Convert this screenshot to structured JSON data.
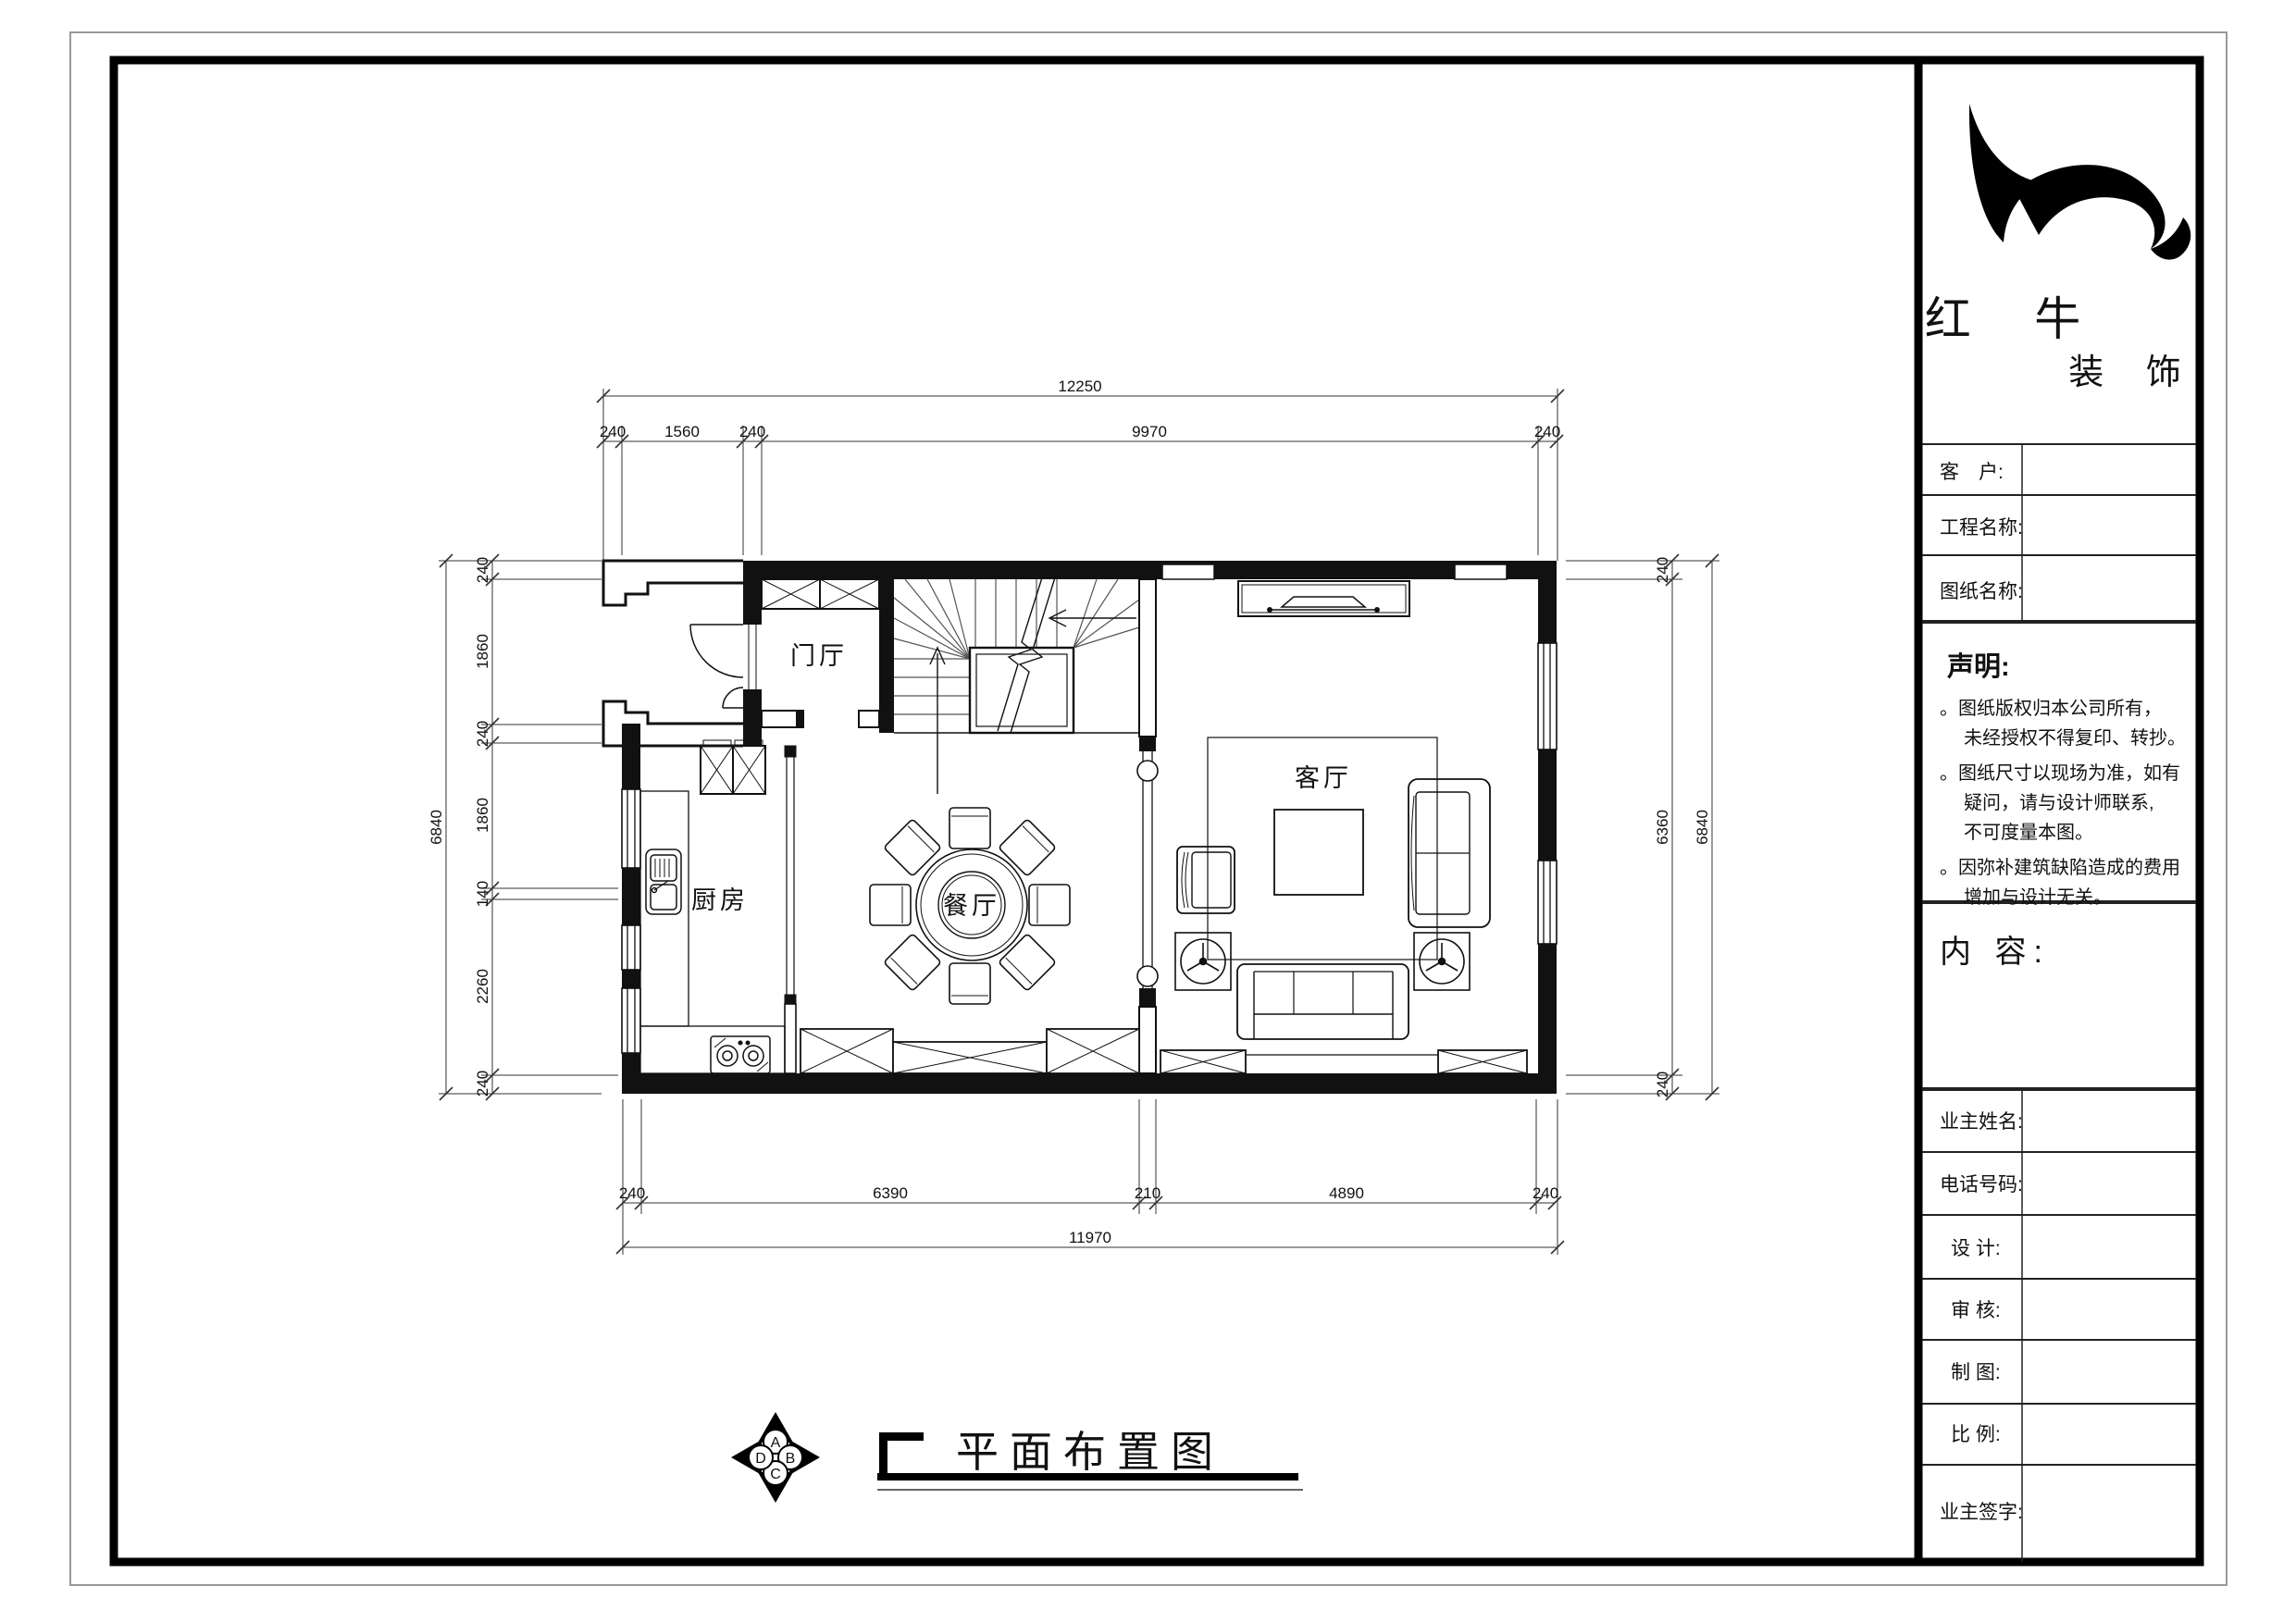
{
  "company": {
    "name_top": "红 牛",
    "name_bottom": "装 饰"
  },
  "title_block": {
    "customer_label": "客　户:",
    "project_label": "工程名称:",
    "drawing_label": "图纸名称:",
    "statement_title": "声明:",
    "statements": [
      "。图纸版权归本公司所有，",
      "未经授权不得复印、转抄。",
      "。图纸尺寸以现场为准，如有",
      "疑问，请与设计师联系,",
      "不可度量本图。",
      "。因弥补建筑缺陷造成的费用",
      "增加与设计无关。"
    ],
    "content_label": "内 容:",
    "owner_name_label": "业主姓名:",
    "phone_label": "电话号码:",
    "design_label": "设 计:",
    "review_label": "审 核:",
    "draft_label": "制 图:",
    "scale_label": "比 例:",
    "owner_sign_label": "业主签字:"
  },
  "rooms": {
    "foyer": "门厅",
    "kitchen": "厨房",
    "dining": "餐厅",
    "living": "客厅"
  },
  "dims": {
    "top_total": "12250",
    "top": [
      "240",
      "1560",
      "240",
      "9970",
      "240"
    ],
    "bottom": [
      "240",
      "6390",
      "210",
      "4890",
      "240"
    ],
    "bottom_total": "11970",
    "left": [
      "240",
      "1860",
      "240",
      "1860",
      "140",
      "2260",
      "240"
    ],
    "left_total": "6840",
    "right": [
      "240",
      "6360",
      "240"
    ],
    "right_total": "6840"
  },
  "drawing_title": "平面布置图",
  "compass": {
    "top": "A",
    "right": "B",
    "bottom": "C",
    "left": "D"
  }
}
